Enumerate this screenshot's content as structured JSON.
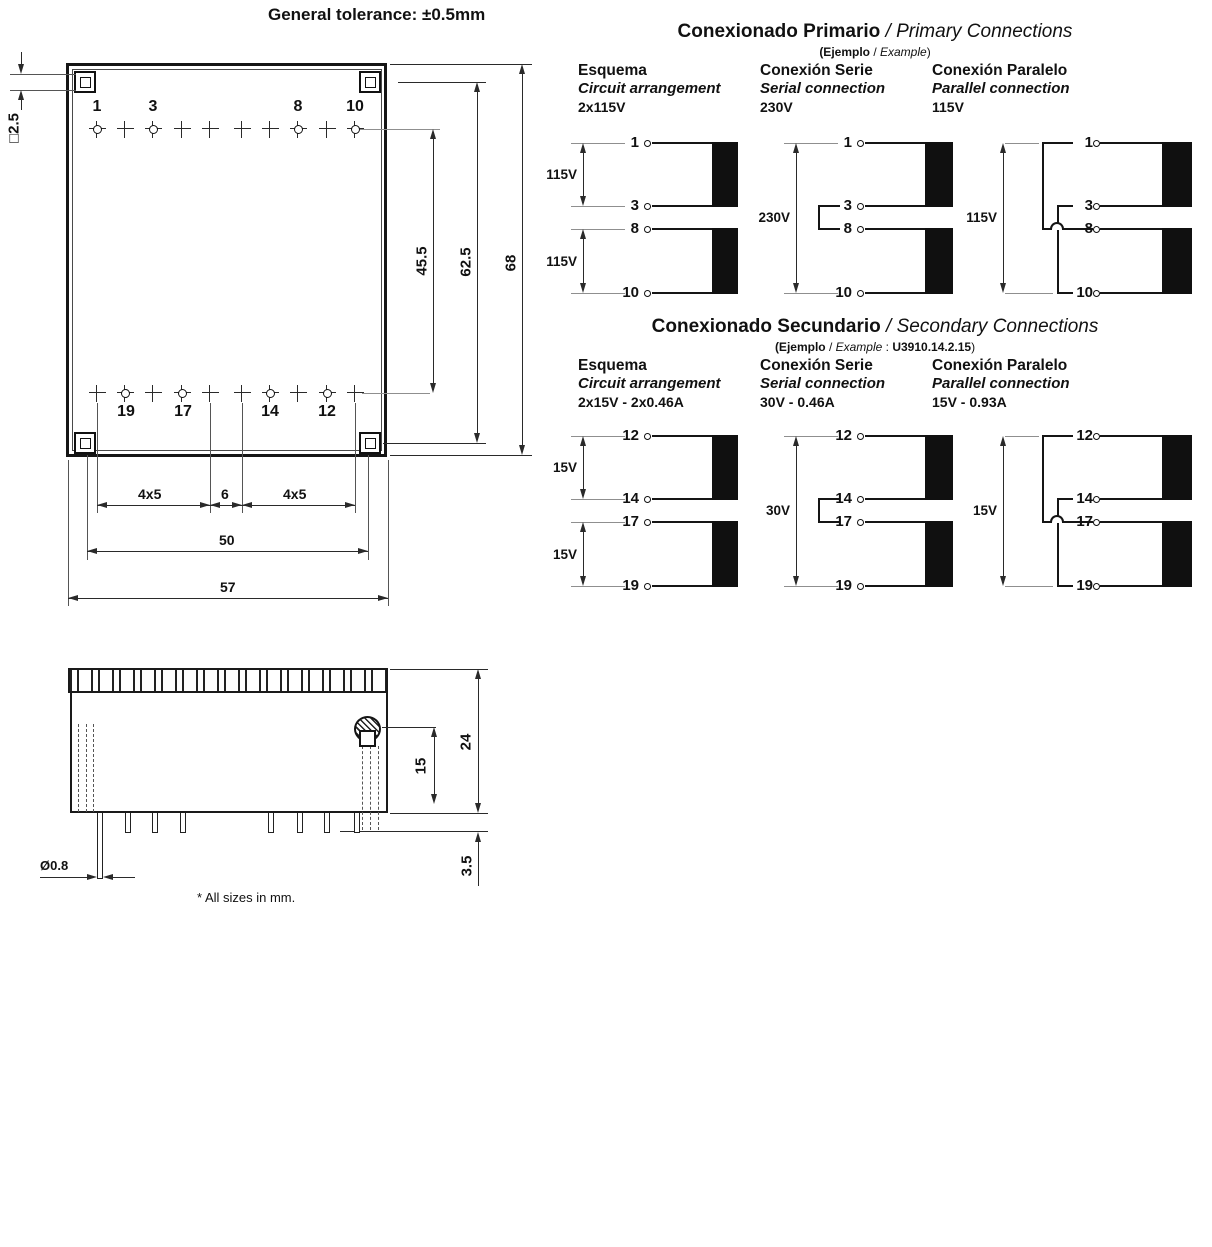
{
  "general": {
    "tolerance": "General tolerance: ±0.5mm",
    "footnote": "* All sizes in mm."
  },
  "top_view": {
    "pins_top": [
      "1",
      "3",
      "8",
      "10"
    ],
    "pins_bottom": [
      "19",
      "17",
      "14",
      "12"
    ],
    "dim_square": "□2.5",
    "dim_pin_rows": "45.5",
    "dim_holes": "62.5",
    "dim_height": "68",
    "dim_pitch_left": "4x5",
    "dim_gap": "6",
    "dim_pitch_right": "4x5",
    "dim_hole_span": "50",
    "dim_width": "57"
  },
  "side_view": {
    "dim_total_height": "24",
    "dim_screw_pos": "15",
    "dim_pin_length": "3.5",
    "dim_pin_diameter": "Ø0.8"
  },
  "primary": {
    "title_es": "Conexionado Primario",
    "title_en": "/ Primary Connections",
    "ex_open": "(Ejemplo",
    "ex_sep": " / ",
    "ex_en": "Example",
    "ex_close": ")",
    "columns": [
      {
        "h1": "Esquema",
        "h2": "Circuit arrangement",
        "h3": "2x115V"
      },
      {
        "h1": "Conexión Serie",
        "h2": "Serial connection",
        "h3": "230V"
      },
      {
        "h1": "Conexión Paralelo",
        "h2": "Parallel connection",
        "h3": "115V"
      }
    ],
    "esquema": {
      "pins": [
        "1",
        "3",
        "8",
        "10"
      ],
      "v1": "115V",
      "v2": "115V"
    },
    "serie": {
      "pins": [
        "1",
        "3",
        "8",
        "10"
      ],
      "v": "230V"
    },
    "paralelo": {
      "pins": [
        "1",
        "3",
        "8",
        "10"
      ],
      "v": "115V"
    }
  },
  "secondary": {
    "title_es": "Conexionado Secundario",
    "title_en": "/ Secondary Connections",
    "ex_open": "(Ejemplo",
    "ex_sep": " / ",
    "ex_en": "Example",
    "ex_colon": " : ",
    "ex_code": "U3910.14.2.15",
    "ex_close": ")",
    "columns": [
      {
        "h1": "Esquema",
        "h2": "Circuit arrangement",
        "h3": "2x15V - 2x0.46A"
      },
      {
        "h1": "Conexión Serie",
        "h2": "Serial connection",
        "h3": "30V - 0.46A"
      },
      {
        "h1": "Conexión Paralelo",
        "h2": "Parallel connection",
        "h3": "15V - 0.93A"
      }
    ],
    "esquema": {
      "pins": [
        "12",
        "14",
        "17",
        "19"
      ],
      "v1": "15V",
      "v2": "15V"
    },
    "serie": {
      "pins": [
        "12",
        "14",
        "17",
        "19"
      ],
      "v": "30V"
    },
    "paralelo": {
      "pins": [
        "12",
        "14",
        "17",
        "19"
      ],
      "v": "15V"
    }
  }
}
